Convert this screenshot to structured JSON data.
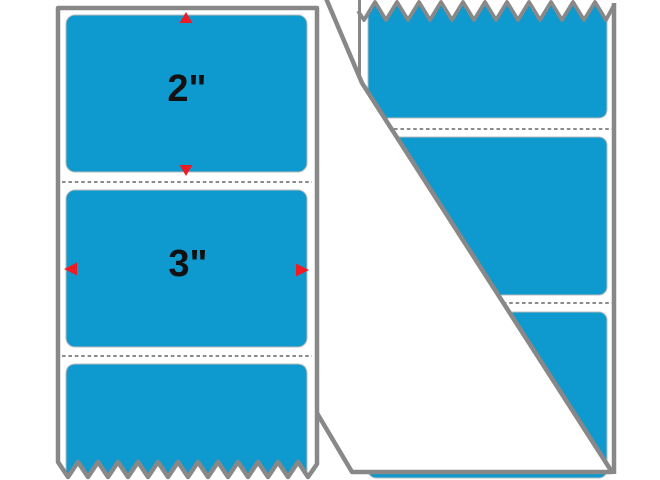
{
  "diagram": {
    "type": "label-dimension-diagram",
    "product": "rectangle labels on liner strip",
    "dimension_width_label": "3\"",
    "dimension_height_label": "2\"",
    "front_strip": {
      "labels_visible": 3,
      "perforation_lines": 2,
      "tear_edge": "bottom-zigzag",
      "dimension_arrows": [
        "up",
        "down",
        "left",
        "right"
      ]
    },
    "peeled_strip": {
      "labels_visible": 3,
      "perforation_lines": 2,
      "tear_edge": "top-zigzag",
      "liner_peeled_back": true
    },
    "colors": {
      "label_blue": "#0e99cf",
      "outline_gray": "#888888",
      "liner_white": "#ffffff",
      "perforation_gray": "#666666",
      "arrow_red": "#ee1b24",
      "dimension_text": "#111111"
    }
  }
}
